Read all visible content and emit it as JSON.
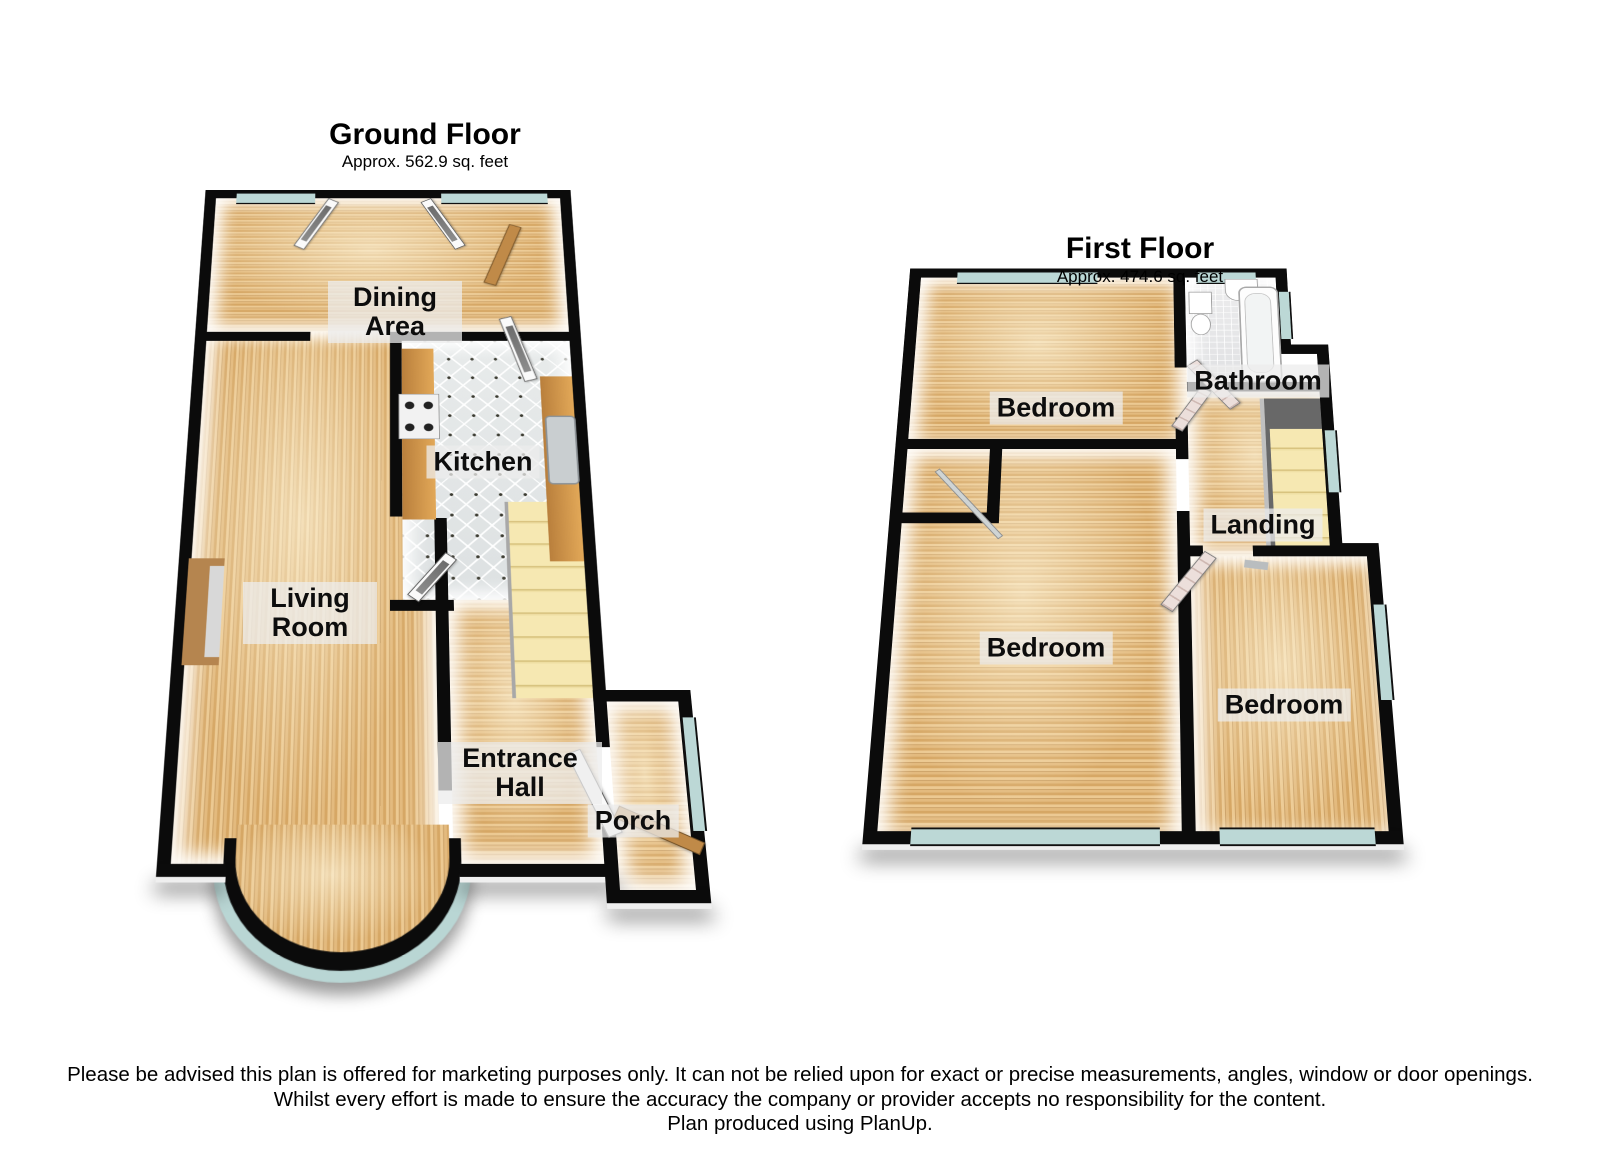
{
  "ground_floor": {
    "title": "Ground Floor",
    "area": "Approx. 562.9 sq. feet",
    "rooms": {
      "dining_area": "Dining Area",
      "kitchen": "Kitchen",
      "living_room": "Living Room",
      "entrance_hall": "Entrance Hall",
      "porch": "Porch"
    }
  },
  "first_floor": {
    "title": "First Floor",
    "area": "Approx. 474.6 sq. feet",
    "rooms": {
      "bedroom_top": "Bedroom",
      "bathroom": "Bathroom",
      "landing": "Landing",
      "bedroom_middle": "Bedroom",
      "bedroom_bottom": "Bedroom"
    }
  },
  "disclaimer": {
    "line1": "Please be advised this plan is offered for marketing purposes only. It can not be relied upon for exact or precise measurements, angles, window or door openings.",
    "line2": "Whilst every effort is made to ensure the accuracy the company or provider accepts no responsibility for the content.",
    "line3": "Plan produced using PlanUp."
  },
  "colors": {
    "wall": "#0b0b0b",
    "wood_floor": "#ddb172",
    "kitchen_tile": "#e9ecec",
    "bathroom_tile": "#e8e8ea",
    "window_glass": "#bcd8d6",
    "stairs": "#f2e3aa",
    "counter_wood": "#c98a42",
    "wooden_door": "#c08a48",
    "label_background": "rgba(236,236,236,0.75)"
  }
}
